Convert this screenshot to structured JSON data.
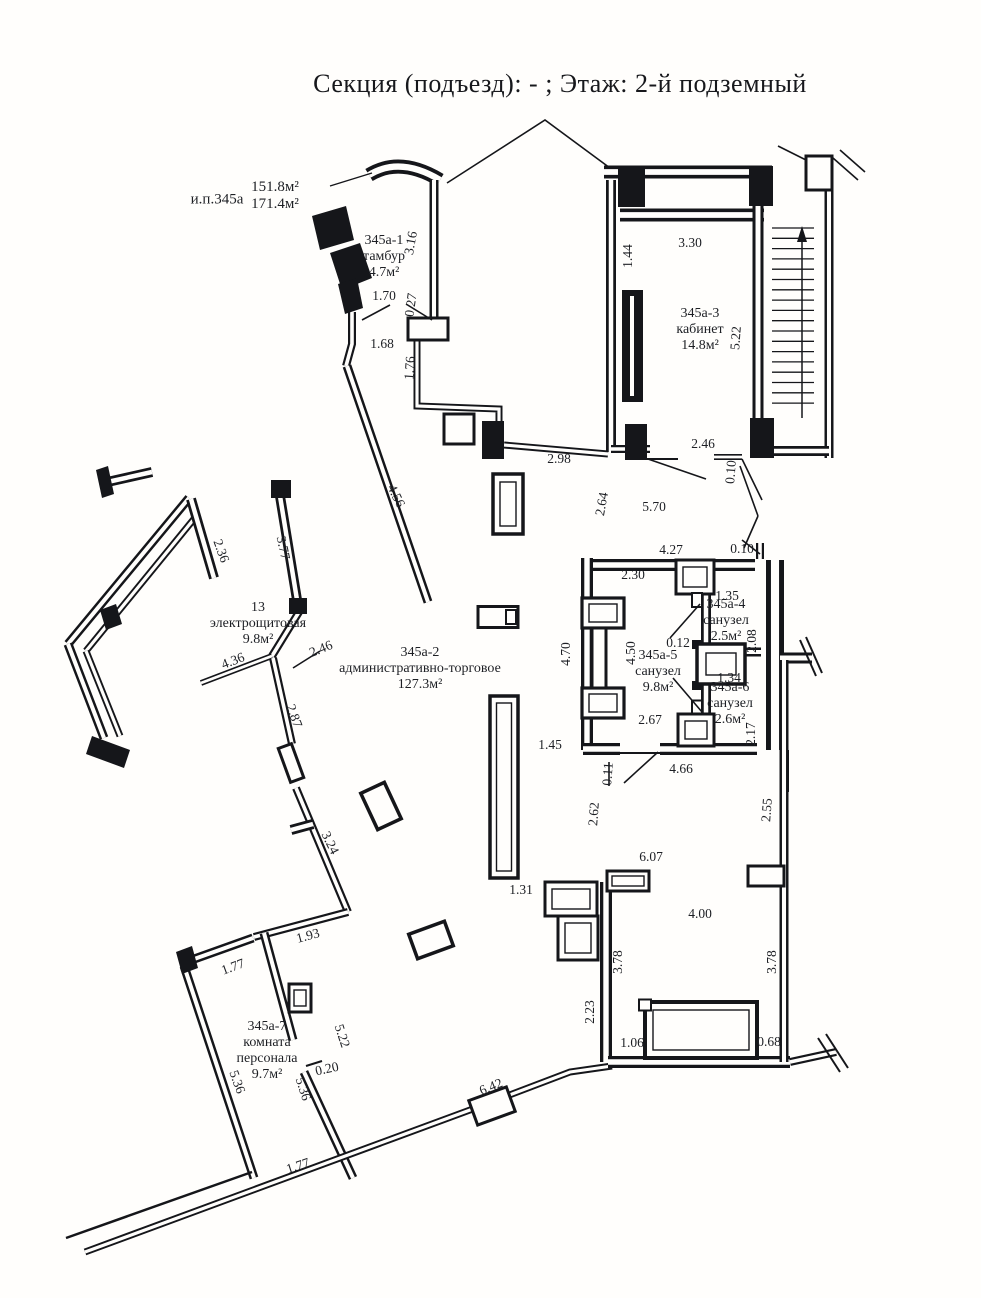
{
  "title": "Секция (подъезд): - ; Этаж: 2-й подземный",
  "room_labels": [
    {
      "id": "ип345а",
      "lines": [
        "и.п.345а"
      ],
      "x": 217,
      "y": 200,
      "fs": 15
    },
    {
      "id": "ип345а-areas",
      "lines": [
        "151.8м²",
        "171.4м²"
      ],
      "x": 275,
      "y": 196,
      "fs": 15
    },
    {
      "id": "345а-1",
      "lines": [
        "345а-1",
        "тамбур",
        "4.7м²"
      ],
      "x": 384,
      "y": 257,
      "fs": 14
    },
    {
      "id": "345а-3",
      "lines": [
        "345а-3",
        "кабинет",
        "14.8м²"
      ],
      "x": 700,
      "y": 330,
      "fs": 14
    },
    {
      "id": "345а-2",
      "lines": [
        "345а-2",
        "административно-торговое",
        "127.3м²"
      ],
      "x": 420,
      "y": 669,
      "fs": 14
    },
    {
      "id": "13",
      "lines": [
        "13",
        "электрощитовая",
        "9.8м²"
      ],
      "x": 258,
      "y": 624,
      "fs": 14
    },
    {
      "id": "345а-4",
      "lines": [
        "345а-4",
        "санузел",
        "2.5м²"
      ],
      "x": 726,
      "y": 621,
      "fs": 14
    },
    {
      "id": "345а-5",
      "lines": [
        "345а-5",
        "санузел",
        "9.8м²"
      ],
      "x": 658,
      "y": 672,
      "fs": 14
    },
    {
      "id": "345а-6",
      "lines": [
        "345а-6",
        "санузел",
        "2.6м²"
      ],
      "x": 730,
      "y": 704,
      "fs": 14
    },
    {
      "id": "345а-7",
      "lines": [
        "345а-7",
        "комната",
        "персонала",
        "9.7м²"
      ],
      "x": 267,
      "y": 1051,
      "fs": 14
    }
  ],
  "dimensions": [
    {
      "t": "3.16",
      "x": 411,
      "y": 243,
      "r": -80
    },
    {
      "t": "1.70",
      "x": 384,
      "y": 296,
      "r": 0
    },
    {
      "t": "0.27",
      "x": 411,
      "y": 305,
      "r": -82
    },
    {
      "t": "1.68",
      "x": 382,
      "y": 344,
      "r": 0
    },
    {
      "t": "1.76",
      "x": 410,
      "y": 368,
      "r": -86
    },
    {
      "t": "4.56",
      "x": 396,
      "y": 496,
      "r": 64
    },
    {
      "t": "2.98",
      "x": 559,
      "y": 459,
      "r": 0
    },
    {
      "t": "3.30",
      "x": 690,
      "y": 243,
      "r": 0
    },
    {
      "t": "1.44",
      "x": 628,
      "y": 256,
      "r": -90
    },
    {
      "t": "5.22",
      "x": 736,
      "y": 338,
      "r": -86
    },
    {
      "t": "2.46",
      "x": 703,
      "y": 444,
      "r": 0
    },
    {
      "t": "0.10",
      "x": 731,
      "y": 472,
      "r": -86
    },
    {
      "t": "2.64",
      "x": 602,
      "y": 504,
      "r": -80
    },
    {
      "t": "5.70",
      "x": 654,
      "y": 507,
      "r": 0
    },
    {
      "t": "4.27",
      "x": 671,
      "y": 550,
      "r": 0
    },
    {
      "t": "0.10",
      "x": 742,
      "y": 549,
      "r": 0
    },
    {
      "t": "2.30",
      "x": 633,
      "y": 575,
      "r": 0
    },
    {
      "t": "1.35",
      "x": 727,
      "y": 596,
      "r": 0
    },
    {
      "t": "2.08",
      "x": 752,
      "y": 641,
      "r": -90
    },
    {
      "t": "0.12",
      "x": 678,
      "y": 643,
      "r": 0
    },
    {
      "t": "4.50",
      "x": 631,
      "y": 653,
      "r": -90
    },
    {
      "t": "1.34",
      "x": 729,
      "y": 678,
      "r": 0
    },
    {
      "t": "2.17",
      "x": 751,
      "y": 734,
      "r": -90
    },
    {
      "t": "2.67",
      "x": 650,
      "y": 720,
      "r": 0
    },
    {
      "t": "4.70",
      "x": 566,
      "y": 654,
      "r": -90
    },
    {
      "t": "1.45",
      "x": 550,
      "y": 745,
      "r": 0
    },
    {
      "t": "0.11",
      "x": 608,
      "y": 774,
      "r": -86
    },
    {
      "t": "4.66",
      "x": 681,
      "y": 769,
      "r": 0
    },
    {
      "t": "2.62",
      "x": 594,
      "y": 814,
      "r": -86
    },
    {
      "t": "2.55",
      "x": 767,
      "y": 810,
      "r": -86
    },
    {
      "t": "6.07",
      "x": 651,
      "y": 857,
      "r": 0
    },
    {
      "t": "1.31",
      "x": 521,
      "y": 890,
      "r": 0
    },
    {
      "t": "4.00",
      "x": 700,
      "y": 914,
      "r": 0
    },
    {
      "t": "3.78",
      "x": 618,
      "y": 962,
      "r": -90
    },
    {
      "t": "3.78",
      "x": 772,
      "y": 962,
      "r": -90
    },
    {
      "t": "2.23",
      "x": 590,
      "y": 1012,
      "r": -90
    },
    {
      "t": "1.06",
      "x": 632,
      "y": 1043,
      "r": 0
    },
    {
      "t": "0.68",
      "x": 769,
      "y": 1042,
      "r": 0
    },
    {
      "t": "6.42",
      "x": 491,
      "y": 1087,
      "r": -22
    },
    {
      "t": "2.36",
      "x": 221,
      "y": 551,
      "r": 70
    },
    {
      "t": "3.77",
      "x": 283,
      "y": 548,
      "r": 78
    },
    {
      "t": "2.46",
      "x": 321,
      "y": 649,
      "r": -22
    },
    {
      "t": "4.36",
      "x": 233,
      "y": 661,
      "r": -21
    },
    {
      "t": "2.87",
      "x": 294,
      "y": 716,
      "r": 70
    },
    {
      "t": "3.24",
      "x": 330,
      "y": 843,
      "r": 64
    },
    {
      "t": "1.93",
      "x": 308,
      "y": 936,
      "r": -15
    },
    {
      "t": "1.77",
      "x": 233,
      "y": 967,
      "r": -20
    },
    {
      "t": "5.22",
      "x": 342,
      "y": 1036,
      "r": 72
    },
    {
      "t": "0.20",
      "x": 327,
      "y": 1069,
      "r": -12
    },
    {
      "t": "5.36",
      "x": 237,
      "y": 1082,
      "r": 70
    },
    {
      "t": "5.36",
      "x": 303,
      "y": 1089,
      "r": 72
    },
    {
      "t": "1.77",
      "x": 298,
      "y": 1166,
      "r": -18
    }
  ]
}
